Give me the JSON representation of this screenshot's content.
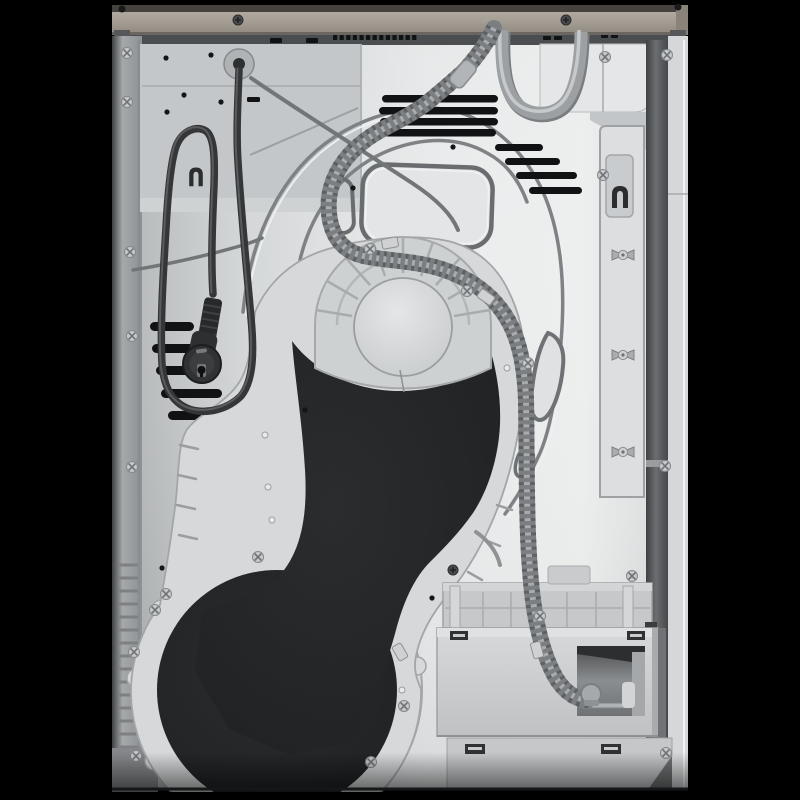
{
  "meta": {
    "subject": "rear-view-of-tumble-dryer",
    "background": "#000000"
  },
  "colors": {
    "background": "#000000",
    "rail": "#a49d94",
    "rail_top": "#45413c",
    "rail_shadow": "#6b665f",
    "gap": "#4b4e50",
    "panel": "#d6d8d9",
    "panel_dark": "#b7babc",
    "panel_bright": "#e9ebec",
    "sheet": "#c4c7c9",
    "strip": "#a6a9ab",
    "strip_edge": "#3f4142",
    "cover": "#d6d8d9",
    "cover_line": "#a3a6a8",
    "pad": "#222426",
    "fan": "#ced1d2",
    "fan_inner": "#d9dbdc",
    "hose": "#7c7f82",
    "hose_rib": "#5e6164",
    "hose_sheen": "#a9acae",
    "tube": "#9da0a2",
    "tube_lite": "#c6c9cb",
    "cord": "#353638",
    "plug": "#2e2f31",
    "grommet": "#b0b3b5",
    "vent": "#111213",
    "hole": "#141516",
    "channel": "#55585a",
    "bracket": "#dcdedf",
    "frame": "#c6c8ca",
    "frame_line": "#a9acae",
    "box": "#cdcfd1",
    "box_lip": "#dfe1e2",
    "recess": "#8b8e90",
    "recess_dark": "#2c2e30",
    "lower_panel": "#c5c7c9",
    "clip_slot": "#2f3133",
    "screw": "#c6c9cb",
    "screw_dark": "#4a4b4d",
    "rivet": "#e8eaeb",
    "wire": "#737678"
  },
  "parts": {
    "rail": "worktop-rear-rail",
    "panel": "back-panel",
    "cord": "power-cord",
    "plug": "schuko-plug",
    "grommet": "cord-grommet",
    "hose": "corrugated-drain-hose",
    "tube": "water-loop-tube",
    "cover": "blower-duct-cover",
    "pad": "insulation-pad",
    "fan": "fan-housing",
    "ring": "drum-bearing-ring",
    "bracket": "mounting-bracket",
    "channel": "rear-frame-channel",
    "box": "condensate-box",
    "recess": "drain-recess",
    "frame": "vent-grid-frame",
    "hooks": "cord-hooks"
  },
  "screws_silver": [
    [
      127,
      53
    ],
    [
      127,
      102
    ],
    [
      130,
      252
    ],
    [
      132,
      336
    ],
    [
      132,
      467
    ],
    [
      134,
      652
    ],
    [
      136,
      756
    ],
    [
      605,
      57
    ],
    [
      667,
      55
    ],
    [
      603,
      175
    ],
    [
      665,
      466
    ],
    [
      666,
      753
    ],
    [
      632,
      576
    ],
    [
      540,
      616
    ],
    [
      258,
      557
    ],
    [
      155,
      610
    ],
    [
      166,
      594
    ],
    [
      371,
      762
    ],
    [
      404,
      706
    ],
    [
      370,
      249
    ],
    [
      467,
      291
    ],
    [
      528,
      363
    ]
  ],
  "screws_dark": [
    [
      238,
      20
    ],
    [
      566,
      20
    ],
    [
      453,
      570
    ]
  ],
  "screws_black": [
    [
      122,
      9
    ],
    [
      678,
      7
    ]
  ],
  "holes": [
    [
      166,
      58
    ],
    [
      211,
      55
    ],
    [
      184,
      95
    ],
    [
      221,
      102
    ],
    [
      167,
      112
    ],
    [
      353,
      188
    ],
    [
      453,
      147
    ],
    [
      305,
      410
    ],
    [
      162,
      568
    ],
    [
      432,
      598
    ]
  ],
  "rivets": [
    [
      265,
      435
    ],
    [
      268,
      487
    ],
    [
      272,
      520
    ],
    [
      507,
      368
    ],
    [
      402,
      690
    ]
  ],
  "vents_top": {
    "h": 7.5,
    "rows": [
      [
        382,
        95,
        116
      ],
      [
        379,
        107,
        119
      ],
      [
        380,
        118,
        118
      ],
      [
        384,
        129,
        112
      ]
    ]
  },
  "vents_stair": {
    "h": 7,
    "rows": [
      [
        495,
        144,
        48
      ],
      [
        505,
        158,
        55
      ],
      [
        516,
        172,
        61
      ],
      [
        529,
        187,
        53
      ]
    ]
  },
  "vents_side": {
    "h": 9,
    "rows": [
      [
        150,
        322,
        44
      ],
      [
        152,
        344,
        53
      ],
      [
        156,
        366,
        59
      ],
      [
        161,
        389,
        61
      ],
      [
        168,
        411,
        62
      ]
    ]
  },
  "slot_row": {
    "x0": 333,
    "y": 35,
    "count": 13,
    "step": 6.6,
    "w": 4.2,
    "h": 5
  },
  "slot_extra": [
    [
      270,
      38,
      12,
      5
    ],
    [
      306,
      38,
      12,
      5
    ],
    [
      543,
      36,
      8,
      4
    ],
    [
      554,
      36,
      8,
      4
    ],
    [
      601,
      34,
      7,
      4
    ],
    [
      611,
      34,
      7,
      4
    ]
  ],
  "spokes": [
    [
      352,
      316,
      316,
      310
    ],
    [
      358,
      299,
      327,
      281
    ],
    [
      370,
      285,
      346,
      258
    ],
    [
      385,
      276,
      373,
      242
    ],
    [
      403,
      273,
      403,
      237
    ],
    [
      421,
      276,
      433,
      242
    ],
    [
      436,
      285,
      460,
      258
    ],
    [
      448,
      299,
      479,
      281
    ],
    [
      454,
      316,
      490,
      310
    ]
  ],
  "ring_tabs": [
    [
      154,
      761
    ],
    [
      136,
      678
    ],
    [
      161,
      609
    ],
    [
      229,
      557
    ],
    [
      314,
      553
    ],
    [
      386,
      599
    ],
    [
      417,
      666
    ]
  ],
  "standoffs": [
    [
      623,
      255
    ],
    [
      623,
      355
    ],
    [
      623,
      452
    ]
  ],
  "clips": [
    [
      390,
      243,
      -10
    ],
    [
      486,
      297,
      35
    ],
    [
      400,
      652,
      60
    ],
    [
      537,
      650,
      75
    ]
  ],
  "strip_ribs": {
    "x1": 119,
    "x2": 138,
    "y0": 565,
    "y1": 748,
    "step": 13
  },
  "frame_ribs_x": [
    455,
    483,
    511,
    539,
    567,
    596,
    624
  ]
}
